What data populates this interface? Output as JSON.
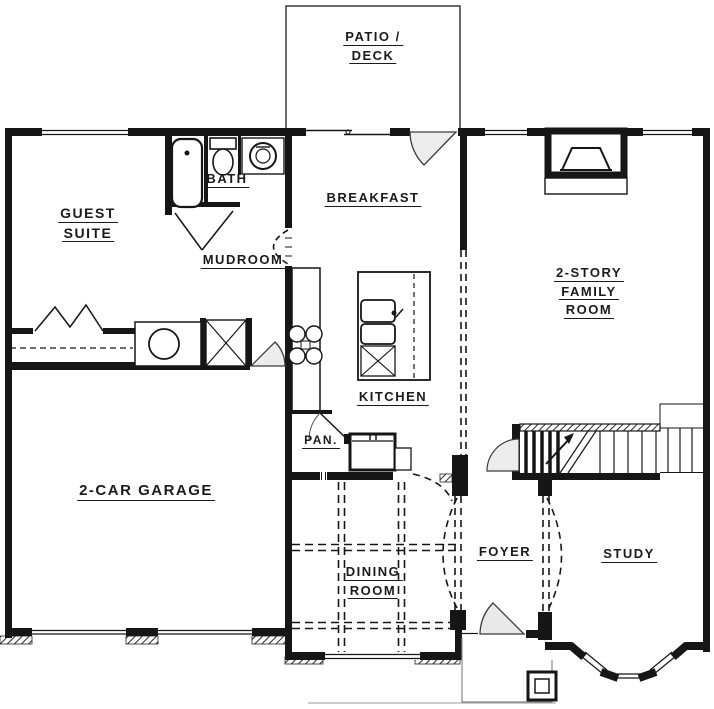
{
  "drawing_title": "Single-family house first-floor plan",
  "colors": {
    "wall": "#161616",
    "background": "#ffffff",
    "label_text": "#1b1b1b",
    "light_line": "#8a8a8a"
  },
  "rooms": {
    "patio_deck": {
      "lines": [
        "PATIO /",
        "DECK"
      ]
    },
    "guest_suite": {
      "lines": [
        "GUEST",
        "SUITE"
      ]
    },
    "bath": {
      "lines": [
        "BATH"
      ]
    },
    "mudroom": {
      "lines": [
        "MUDROOM"
      ]
    },
    "breakfast": {
      "lines": [
        "BREAKFAST"
      ]
    },
    "kitchen": {
      "lines": [
        "KITCHEN"
      ]
    },
    "pantry": {
      "lines": [
        "PAN."
      ]
    },
    "family_room": {
      "lines": [
        "2-STORY",
        "FAMILY",
        "ROOM"
      ]
    },
    "garage": {
      "lines": [
        "2-CAR GARAGE"
      ]
    },
    "dining_room": {
      "lines": [
        "DINING",
        "ROOM"
      ]
    },
    "foyer": {
      "lines": [
        "FOYER"
      ]
    },
    "study": {
      "lines": [
        "STUDY"
      ]
    }
  }
}
